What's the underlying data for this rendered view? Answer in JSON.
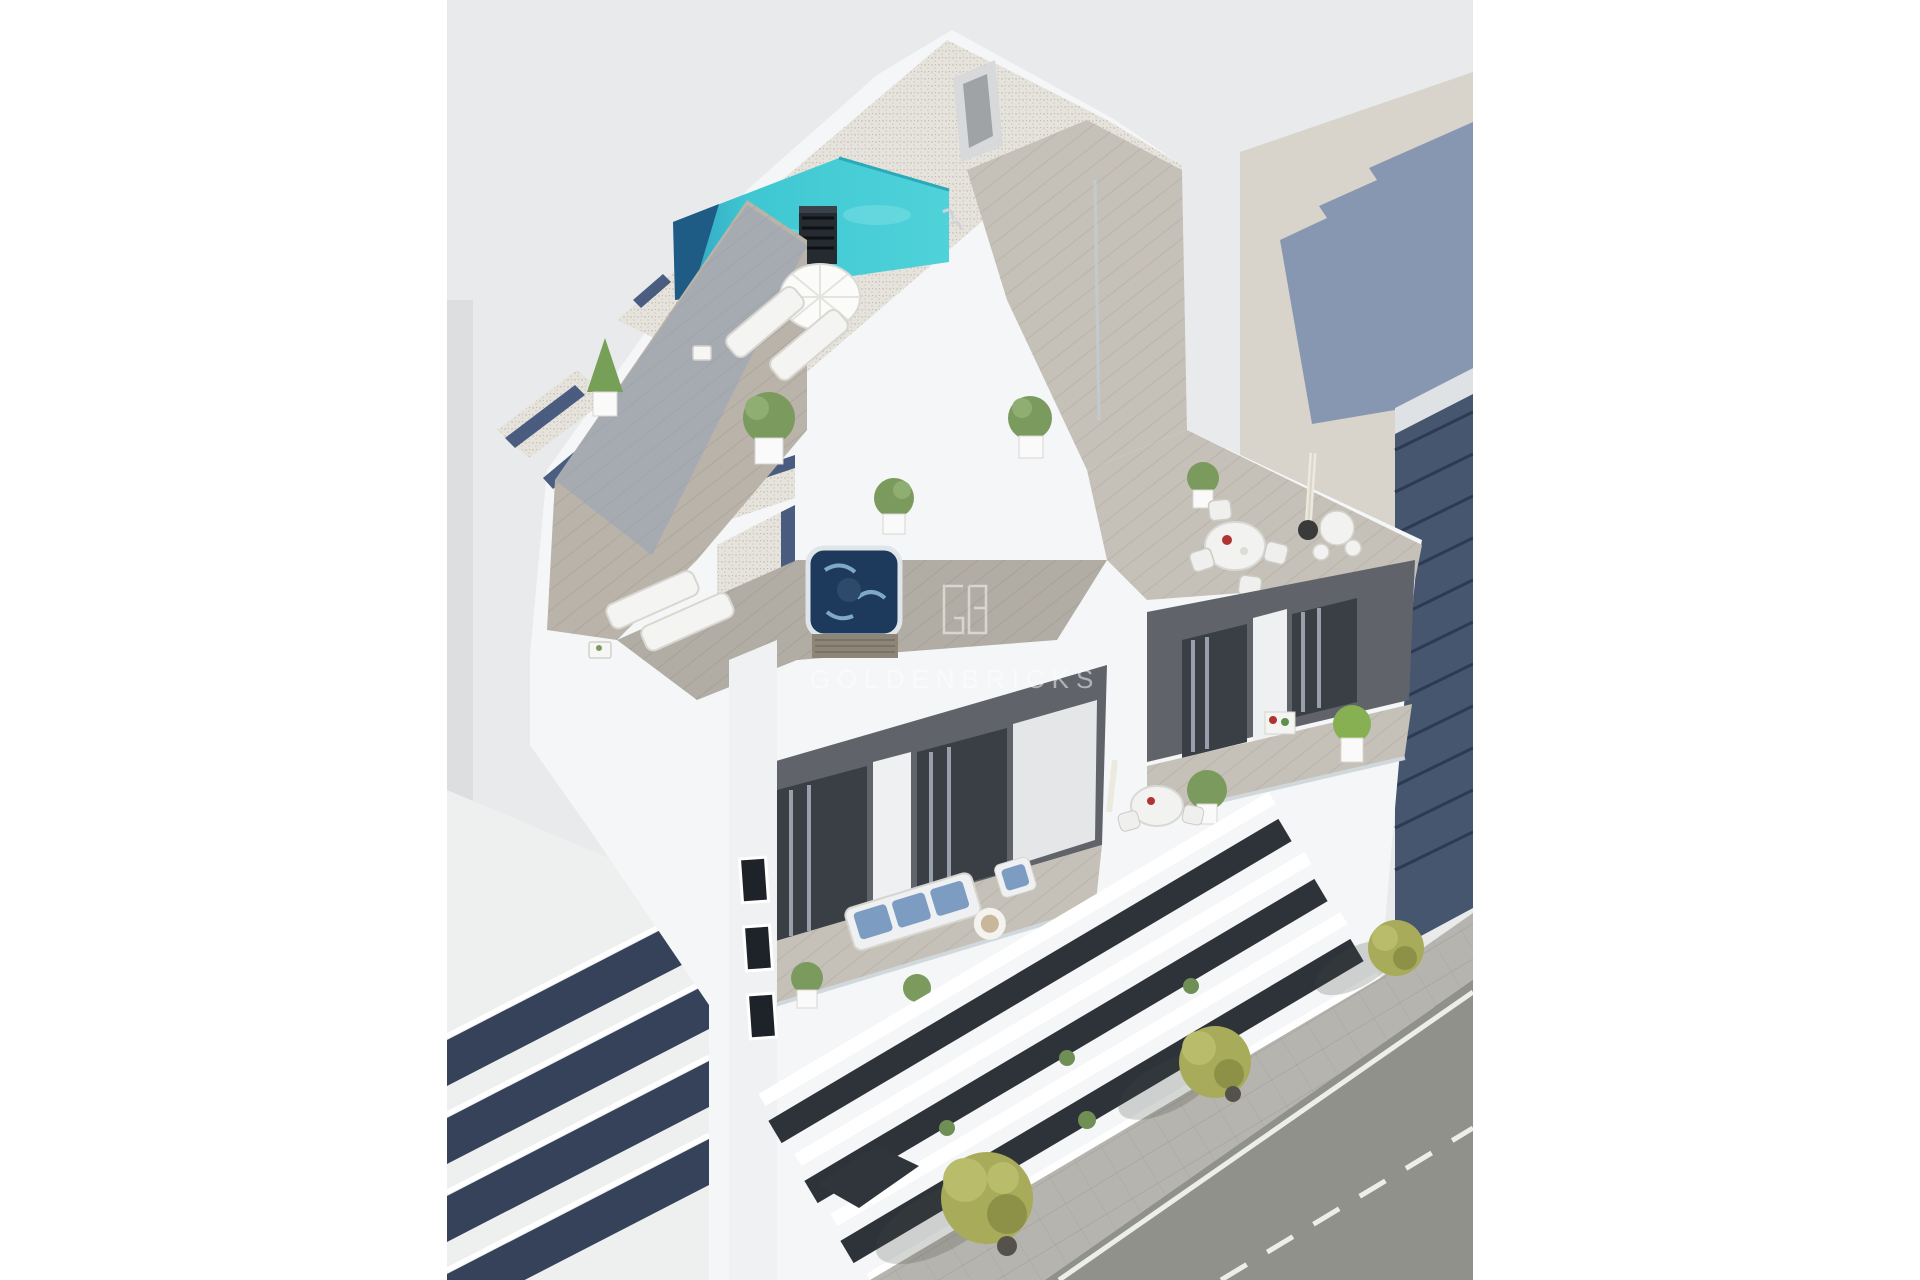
{
  "image": {
    "type": "architectural-aerial-render",
    "subject": "new-build white apartment block with rooftop pool, jacuzzi terraces, balconies and street",
    "canvas": {
      "width": 1920,
      "height": 1280,
      "background": "#ffffff"
    },
    "photo": {
      "left": 447,
      "top": 0,
      "width": 1026,
      "height": 1280
    }
  },
  "watermark": {
    "text": "GOLDENBRICKS",
    "logo": "gb-monogram-square-icon",
    "color": "#ffffff",
    "opacity": 0.5
  },
  "palette": {
    "backdrop_gray": "#e9eaeb",
    "backdrop_beige": "#d8d4cb",
    "shadow_blue": "#7f90ae",
    "building_white": "#f5f6f7",
    "wall_shade": "#dde0e2",
    "gravel": "#e6e3dc",
    "gravel_dot": "#c7c3ba",
    "deck_wood": "#b9b3aa",
    "deck_wood_light": "#c6c1b8",
    "deck_shadow": "#93a3b8",
    "pool_turquoise": "#3fc8d2",
    "pool_light": "#8ce4e8",
    "pool_deep": "#1e5c86",
    "skylight_navy": "#3d5178",
    "jacuzzi_navy": "#1d3a5c",
    "chimney_black": "#262b31",
    "accent_wall_gray": "#60646a",
    "glass_dark": "#3a3f46",
    "curtain_gray": "#aab2bd",
    "sofa_blue": "#7d9cc2",
    "plant_green": "#7b9a5e",
    "tree_olive": "#a8ab59",
    "asphalt": "#8f918a",
    "sidewalk": "#b6b4ae",
    "road_line": "#eceee9",
    "neighbor_band_navy": "#36425a",
    "neighbor_glass": "#46566f",
    "furniture_white": "#f2f2f0"
  },
  "scene_objects": [
    "backdrop-walls",
    "rooftop-pool",
    "pool-ladder",
    "chimney-vent",
    "gravel-roofs",
    "skylight-strips",
    "wood-deck",
    "sun-parasol",
    "sun-loungers",
    "topiary-plant",
    "jacuzzi",
    "potted-plants",
    "dining-table-set",
    "bar-table-set",
    "closed-parasol",
    "accent-walls",
    "glass-doors",
    "outdoor-sofa-set",
    "coffee-table",
    "balcony-railings",
    "stair-windows",
    "facade-balcony-bands",
    "left-neighbor-building",
    "right-neighbor-building",
    "sidewalk",
    "road",
    "road-markings",
    "street-trees",
    "tree-shadows",
    "watermark"
  ]
}
